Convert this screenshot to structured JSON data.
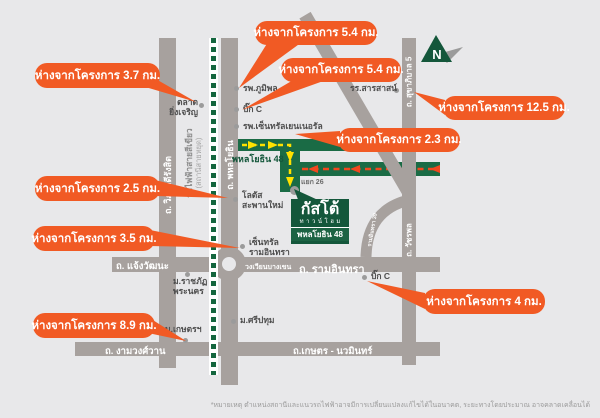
{
  "colors": {
    "background": "#E8E8EA",
    "callout_orange": "#F15A24",
    "road_gray": "#A7A19E",
    "route_green": "#1A6B45",
    "logo_green": "#14573B",
    "rail_green": "#14663E",
    "arrow_yellow": "#FFE100",
    "arrow_red": "#F2481F"
  },
  "project_logo": {
    "name": "กัสโต้",
    "type": "ทาวน์โฮม",
    "location": "พหลโยธิน 48"
  },
  "compass": {
    "label": "N"
  },
  "callouts": [
    {
      "label": "ห่างจากโครงการ 3.7 กม."
    },
    {
      "label": "ห่างจากโครงการ 5.4 กม."
    },
    {
      "label": "ห่างจากโครงการ 5.4 กม."
    },
    {
      "label": "ห่างจากโครงการ 12.5 กม."
    },
    {
      "label": "ห่างจากโครงการ 2.3 กม."
    },
    {
      "label": "ห่างจากโครงการ 2.5 กม."
    },
    {
      "label": "ห่างจากโครงการ 3.5 กม."
    },
    {
      "label": "ห่างจากโครงการ 8.9 กม."
    },
    {
      "label": "ห่างจากโครงการ 4 กม."
    }
  ],
  "roads": {
    "viphavadi_rangsit": "ถ. วิภาวดีรังสิต",
    "phahonyothin": "ถ. พหลโยธิน",
    "sukhaphiban_5": "ถ. สุขาภิบาล 5",
    "watcharaphon": "ถ. วัชรพล",
    "chaengwattana": "ถ. แจ้งวัฒนะ",
    "ramindra": "ถ. รามอินทรา",
    "bangkhen_roundabout": "วงเวียนบางเขน",
    "ngamwongwan": "ถ. งามวงศ์วาน",
    "kaset_nawamin": "ถ.เกษตร - นวมินทร์",
    "ramindra_39": "รามอินทรา 39",
    "soi_phahonyothin_48": "พหลโยธิน 48",
    "junction_26": "แยก 26"
  },
  "railway": {
    "line_name": "รถไฟฟ้าสายสีเขียว",
    "station_note": "(สถานีสายหยุด)"
  },
  "landmarks": {
    "talad_yingcharoen": {
      "line1": "ตลาด",
      "line2": "ยิ่งเจริญ"
    },
    "bhumibol_hospital": {
      "line1": "รพ.ภูมิพล"
    },
    "big_c_saphanmai": {
      "line1": "บิ๊ก C"
    },
    "central_general_hospital": {
      "line1": "รพ.เซ็นทรัลเยนเนอรัล"
    },
    "sarasas_school": {
      "line1": "รร.สารสาสน์"
    },
    "lotus_saphanmai": {
      "line1": "โลตัส",
      "line2": "สะพานใหม่"
    },
    "central_ramindra": {
      "line1": "เซ็นทรัล",
      "line2": "รามอินทรา"
    },
    "rajabhat_phranakhon": {
      "line1": "ม.ราชภัฏ",
      "line2": "พระนคร"
    },
    "sripatum_university": {
      "line1": "ม.ศรีปทุม"
    },
    "kasetsart_university": {
      "line1": "ม.เกษตรฯ"
    },
    "big_c_ramindra": {
      "line1": "บิ๊ก C"
    }
  },
  "footnote": {
    "text": "*หมายเหตุ ตำแหน่งสถานีและแนวรถไฟฟ้าอาจมีการเปลี่ยนแปลงแก้ไขได้ในอนาคต, ระยะทางโดยประมาณ อาจคลาดเคลื่อนได้"
  }
}
